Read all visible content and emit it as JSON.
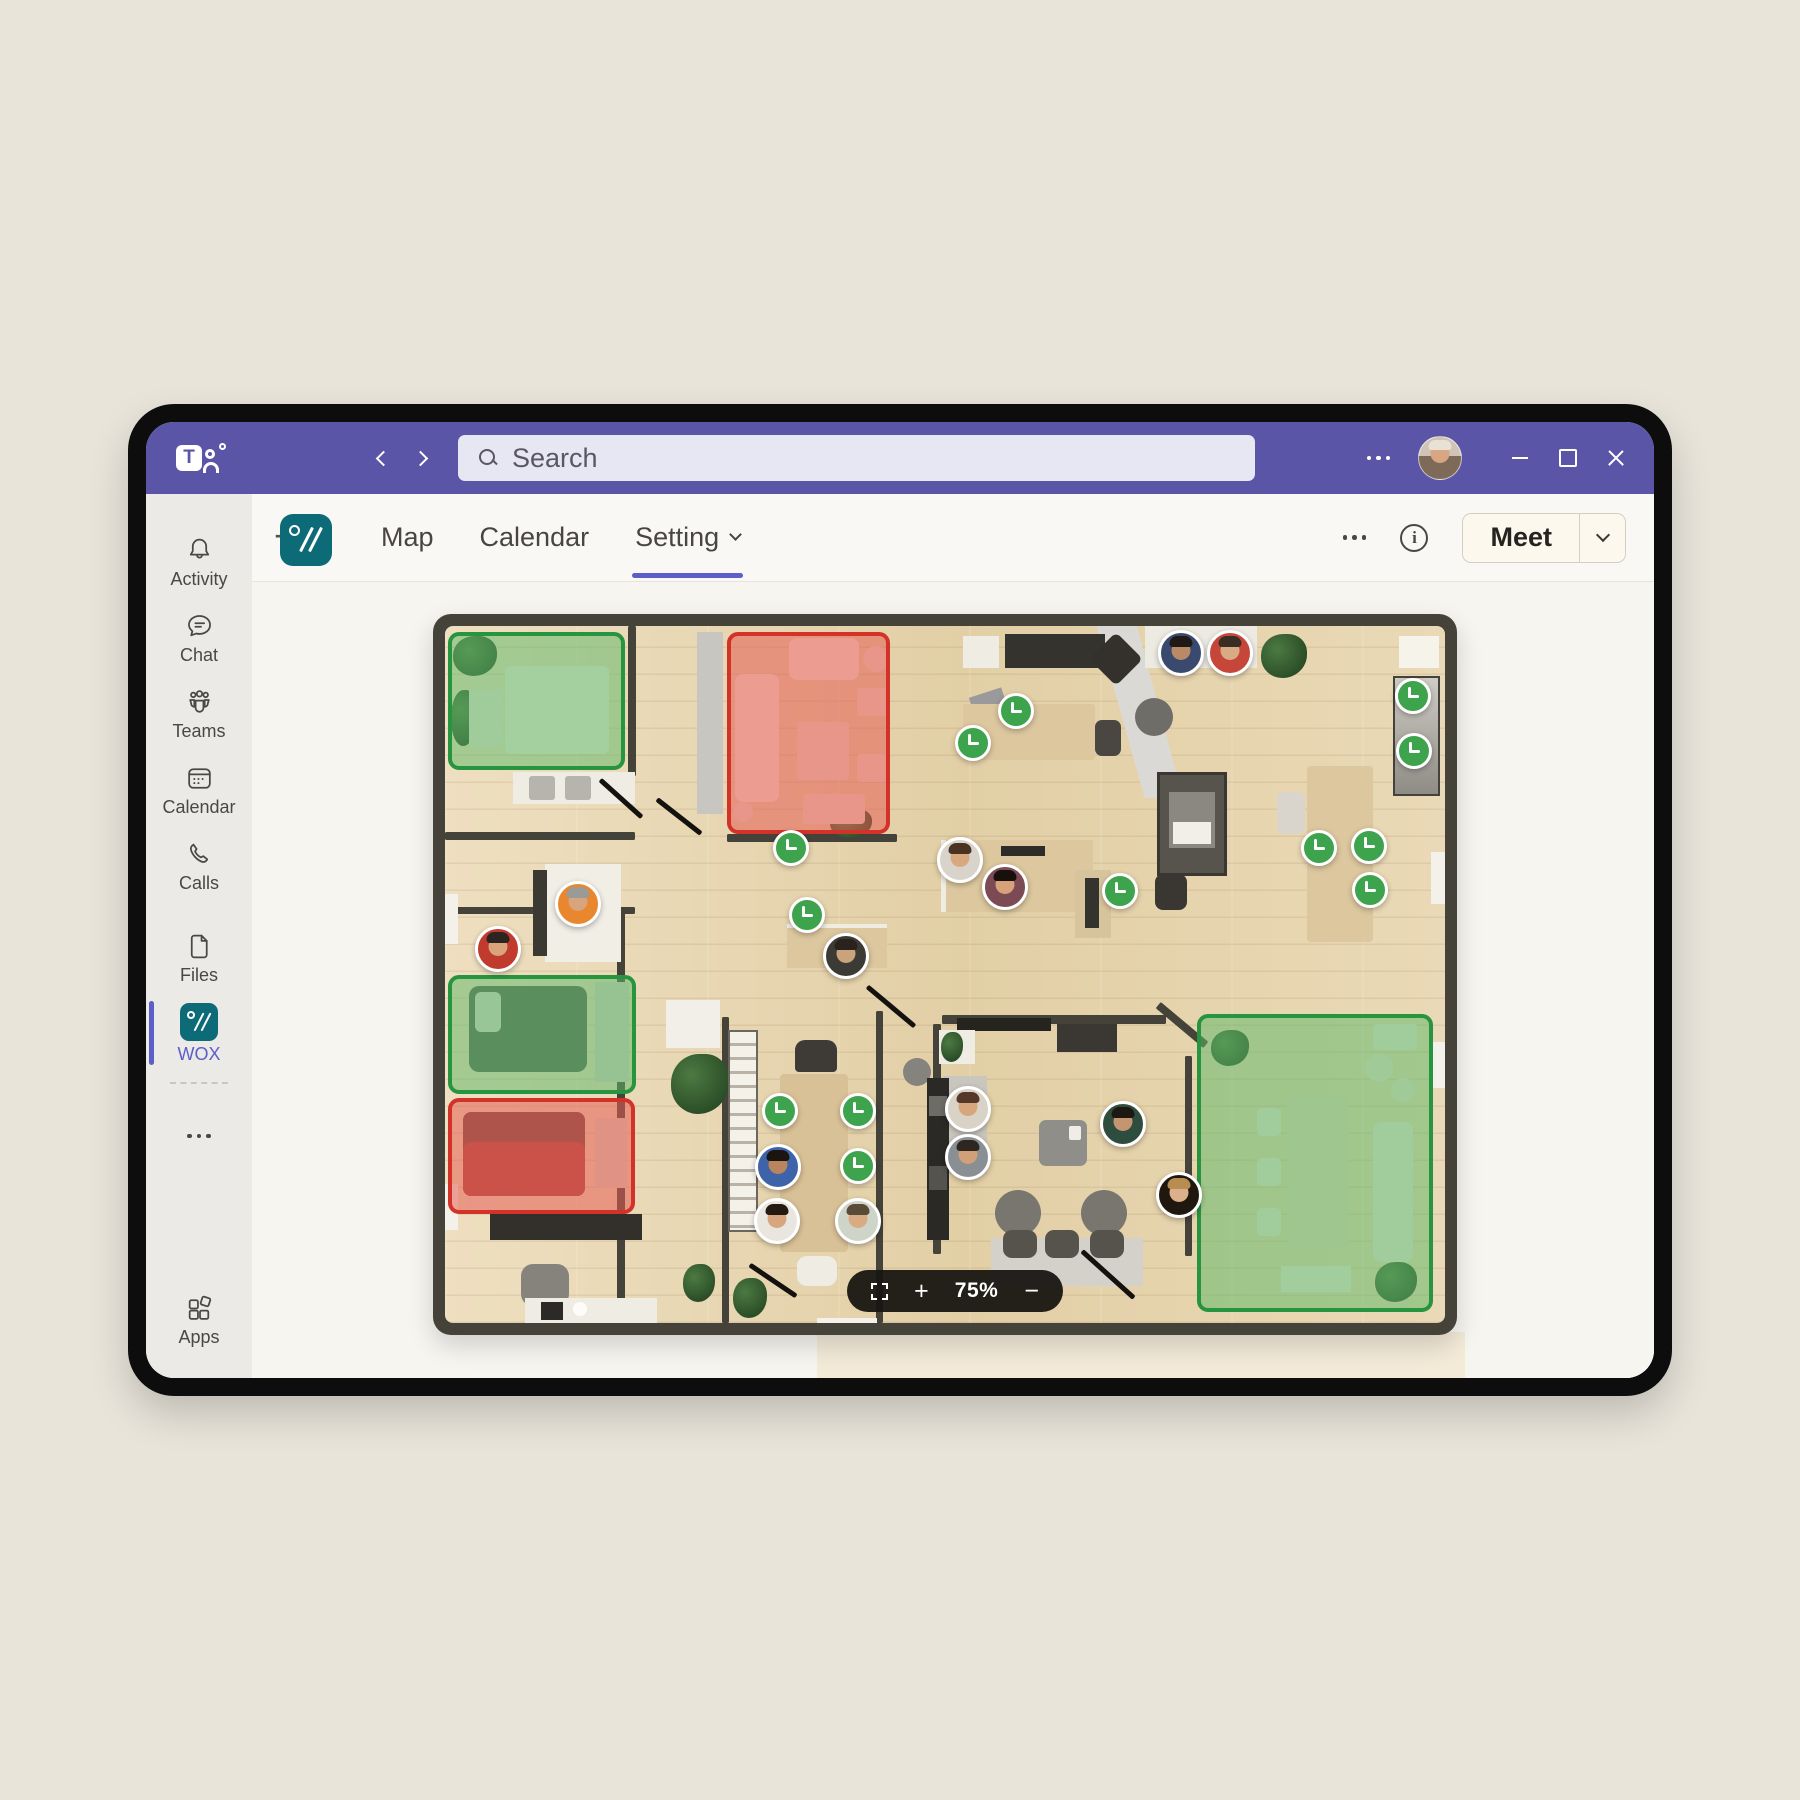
{
  "brand": {
    "teams_letter": "T"
  },
  "titlebar": {
    "search_placeholder": "Search"
  },
  "sidebar": {
    "items": [
      {
        "id": "activity",
        "label": "Activity"
      },
      {
        "id": "chat",
        "label": "Chat"
      },
      {
        "id": "teams",
        "label": "Teams"
      },
      {
        "id": "calendar",
        "label": "Calendar"
      },
      {
        "id": "calls",
        "label": "Calls"
      },
      {
        "id": "files",
        "label": "Files"
      },
      {
        "id": "wox",
        "label": "WOX"
      }
    ],
    "apps_label": "Apps"
  },
  "tabbar": {
    "tabs": [
      {
        "label": "Map",
        "cls": ""
      },
      {
        "label": "Calendar",
        "cls": ""
      },
      {
        "label": "Setting",
        "cls": "active has-caret"
      }
    ],
    "add_label": "+",
    "info_letter": "i",
    "meet_label": "Meet"
  },
  "map": {
    "zoom_level": "75%",
    "zoom_plus": "+",
    "zoom_minus": "−",
    "status_colors": {
      "available": "#27943f",
      "busy": "#d23228",
      "clock_badge": "#3ea34d"
    },
    "zones": [
      {
        "kind": "available",
        "cls": "available",
        "css": "left:3px;top:6px;width:177px;height:138px"
      },
      {
        "kind": "busy",
        "cls": "busy",
        "css": "left:282px;top:6px;width:163px;height:202px"
      },
      {
        "kind": "available",
        "cls": "available",
        "css": "left:3px;top:349px;width:188px;height:119px"
      },
      {
        "kind": "busy",
        "cls": "busy",
        "css": "left:3px;top:472px;width:187px;height:116px"
      },
      {
        "kind": "available",
        "cls": "available",
        "css": "left:752px;top:388px;width:236px;height:298px"
      }
    ],
    "clocks": [
      {
        "css": "left:328px;top:204px"
      },
      {
        "css": "left:344px;top:271px"
      },
      {
        "css": "left:553px;top:67px"
      },
      {
        "css": "left:510px;top:99px"
      },
      {
        "css": "left:950px;top:52px"
      },
      {
        "css": "left:951px;top:107px"
      },
      {
        "css": "left:856px;top:204px"
      },
      {
        "css": "left:906px;top:202px"
      },
      {
        "css": "left:907px;top:246px"
      },
      {
        "css": "left:657px;top:247px"
      },
      {
        "css": "left:317px;top:467px"
      },
      {
        "css": "left:395px;top:467px"
      },
      {
        "css": "left:395px;top:522px"
      }
    ],
    "people": [
      {
        "css": "left:110px;top:255px;--skin:#d7a47e;--hair:#9a9a96;--shirt:#e8872e"
      },
      {
        "css": "left:30px;top:300px;--skin:#d9a47c;--hair:#2c2420;--shirt:#c03a2e"
      },
      {
        "css": "left:378px;top:307px;--skin:#caa27c;--hair:#2a221c;--shirt:#3c3a34"
      },
      {
        "css": "left:713px;top:4px;--skin:#b98a66;--hair:#201a16;--shirt:#3a4a6e"
      },
      {
        "css": "left:762px;top:4px;--skin:#d9ab84;--hair:#3a2e24;--shirt:#c6473a"
      },
      {
        "css": "left:492px;top:211px;--skin:#d9a87f;--hair:#4a3322;--shirt:#d8d4cc"
      },
      {
        "css": "left:537px;top:238px;--skin:#d7a27a;--hair:#17100c;--shirt:#7b4a55"
      },
      {
        "css": "left:310px;top:518px;--skin:#b9845e;--hair:#1c140e;--shirt:#3e63a8"
      },
      {
        "css": "left:309px;top:572px;--skin:#d8a67e;--hair:#241a12;--shirt:#e9e6df"
      },
      {
        "css": "left:390px;top:572px;--skin:#d9ab82;--hair:#5a4a38;--shirt:#cfd4c8"
      },
      {
        "css": "left:500px;top:460px;--skin:#d8a67c;--hair:#55382a;--shirt:#d9d2c6"
      },
      {
        "css": "left:500px;top:508px;--skin:#d2a078;--hair:#2e2620;--shirt:#8a8f94"
      },
      {
        "css": "left:655px;top:475px;--skin:#c59470;--hair:#1e1813;--shirt:#2f4d3e"
      },
      {
        "css": "left:711px;top:546px;--skin:#dcb08a;--hair:#b98c52;--shirt:#20180f"
      }
    ],
    "furniture": [
      {
        "cls": "f-wall",
        "css": "left:183px;top:0;width:8px;height:150px"
      },
      {
        "cls": "f-wall",
        "css": "left:0;top:206px;width:190px;height:8px"
      },
      {
        "cls": "f-wall",
        "css": "left:282px;top:208px;width:170px;height:8px"
      },
      {
        "cls": "f-wall",
        "css": "left:0;top:281px;width:190px;height:7px"
      },
      {
        "cls": "f-wall",
        "css": "left:172px;top:281px;width:8px;height:416px"
      },
      {
        "cls": "f-wall",
        "css": "left:277px;top:391px;width:7px;height:306px"
      },
      {
        "cls": "f-wall",
        "css": "left:431px;top:385px;width:7px;height:312px"
      },
      {
        "cls": "f-wall",
        "css": "left:497px;top:389px;width:224px;height:9px"
      },
      {
        "cls": "f-wall",
        "css": "left:488px;top:398px;width:8px;height:230px"
      },
      {
        "cls": "f-wall",
        "css": "left:706px;top:395px;width:62px;height:8px;transform:rotate(40deg)"
      },
      {
        "cls": "f-wall",
        "css": "left:740px;top:430px;width:7px;height:200px"
      },
      {
        "cls": "f",
        "css": "left:252px;top:6px;width:26px;height:182px;background:#c8c6c1"
      },
      {
        "cls": "f",
        "css": "left:642px;top:0;width:96px;height:172px;background:#dbd9d5;clip-path:polygon(10% 0,52% 0,100% 100%,60% 100%)"
      },
      {
        "cls": "f",
        "css": "left:372px;top:692px;width:60px;height:7px;background:#f4f1ea"
      },
      {
        "cls": "f",
        "css": "left:68px;top:146px;width:122px;height:32px;background:#efece3"
      },
      {
        "cls": "f",
        "css": "left:84px;top:150px;width:26px;height:24px;background:#b7b4ae;border-radius:3px"
      },
      {
        "cls": "f",
        "css": "left:120px;top:150px;width:26px;height:24px;background:#b7b4ae;border-radius:3px"
      },
      {
        "cls": "f",
        "css": "left:100px;top:238px;width:76px;height:98px;background:#f1eee6"
      },
      {
        "cls": "f",
        "css": "left:88px;top:244px;width:14px;height:86px;background:#3c3933"
      },
      {
        "cls": "f",
        "css": "left:342px;top:298px;width:100px;height:44px;background:#dcc79e;border-top:4px solid #efece4"
      },
      {
        "cls": "f",
        "css": "left:560px;top:8px;width:100px;height:34px;background:#35332e"
      },
      {
        "cls": "f",
        "css": "left:518px;top:10px;width:36px;height:32px;background:#efece4"
      },
      {
        "cls": "f",
        "css": "left:527px;top:66px;width:34px;height:26px;background:#9b999b;transform:rotate(-18deg)"
      },
      {
        "cls": "f",
        "css": "left:652px;top:14px;width:38px;height:38px;background:#34312c;transform:rotate(45deg);border-radius:6px"
      },
      {
        "cls": "f",
        "css": "left:518px;top:78px;width:132px;height:56px;background:#dcc79e;border-radius:3px"
      },
      {
        "cls": "f",
        "css": "left:650px;top:94px;width:26px;height:36px;background:#4a4742;border-radius:7px"
      },
      {
        "cls": "f",
        "css": "left:690px;top:72px;width:38px;height:38px;background:#6f6d68;border-radius:50%"
      },
      {
        "cls": "f",
        "css": "left:700px;top:0;width:112px;height:42px;background:#edeae2"
      },
      {
        "cls": "f-plant",
        "css": "left:816px;top:8px;width:46px;height:44px"
      },
      {
        "cls": "f",
        "css": "left:954px;top:10px;width:40px;height:32px;background:#f6f3ea"
      },
      {
        "cls": "f",
        "css": "left:948px;top:50px;width:47px;height:120px;background:linear-gradient(#cfccc6,#8f8c86);border:2px solid #45423a"
      },
      {
        "cls": "f",
        "css": "left:712px;top:146px;width:70px;height:104px;background:#57544e;border:3px solid #3a3732"
      },
      {
        "cls": "f",
        "css": "left:724px;top:166px;width:46px;height:56px;background:#8b8881"
      },
      {
        "cls": "f",
        "css": "left:728px;top:196px;width:38px;height:22px;background:#f1efe8"
      },
      {
        "cls": "f",
        "css": "left:862px;top:140px;width:66px;height:176px;background:#dcc79e;border-radius:4px"
      },
      {
        "cls": "f",
        "css": "left:832px;top:166px;width:28px;height:42px;background:#d9d5cc;border-radius:7px"
      },
      {
        "cls": "f",
        "css": "left:986px;top:226px;width:14px;height:52px;background:#f4f1ea"
      },
      {
        "cls": "f",
        "css": "left:986px;top:416px;width:14px;height:46px;background:#f4f1ea"
      },
      {
        "cls": "f",
        "css": "left:496px;top:214px;width:152px;height:72px;background:#dcc79e;border-left:5px solid #efece4"
      },
      {
        "cls": "f",
        "css": "left:556px;top:220px;width:44px;height:10px;background:#2e2c28"
      },
      {
        "cls": "f",
        "css": "left:630px;top:244px;width:36px;height:68px;background:#d8c49c"
      },
      {
        "cls": "f",
        "css": "left:640px;top:252px;width:14px;height:50px;background:#35332e"
      },
      {
        "cls": "f",
        "css": "left:710px;top:248px;width:32px;height:36px;background:#3a3733;border-radius:8px"
      },
      {
        "cls": "f",
        "css": "left:512px;top:392px;width:94px;height:13px;background:#26241f"
      },
      {
        "cls": "f",
        "css": "left:612px;top:398px;width:60px;height:28px;background:#3b3833"
      },
      {
        "cls": "f",
        "css": "left:494px;top:404px;width:36px;height:34px;background:#efece4"
      },
      {
        "cls": "f-plant",
        "css": "left:496px;top:406px;width:22px;height:30px"
      },
      {
        "cls": "f",
        "css": "left:458px;top:432px;width:28px;height:28px;background:#85837d;border-radius:50%"
      },
      {
        "cls": "f",
        "css": "left:498px;top:450px;width:44px;height:98px;background:#c9c6be"
      },
      {
        "cls": "f",
        "css": "left:594px;top:494px;width:48px;height:46px;background:#908e89;border-radius:7px"
      },
      {
        "cls": "f",
        "css": "left:624px;top:500px;width:12px;height:14px;background:#f0ede6;border-radius:2px"
      },
      {
        "cls": "f",
        "css": "left:550px;top:564px;width:46px;height:46px;background:#78766f;border-radius:50%"
      },
      {
        "cls": "f",
        "css": "left:636px;top:564px;width:46px;height:46px;background:#78766f;border-radius:50%"
      },
      {
        "cls": "f",
        "css": "left:546px;top:612px;width:152px;height:48px;background:#d4d1ca"
      },
      {
        "cls": "f",
        "css": "left:558px;top:604px;width:34px;height:28px;background:#56534d;border-radius:9px"
      },
      {
        "cls": "f",
        "css": "left:600px;top:604px;width:34px;height:28px;background:#56534d;border-radius:9px"
      },
      {
        "cls": "f",
        "css": "left:645px;top:604px;width:34px;height:28px;background:#56534d;border-radius:9px"
      },
      {
        "cls": "f",
        "css": "left:482px;top:452px;width:22px;height:162px;background:#2b2926"
      },
      {
        "cls": "f",
        "css": "left:484px;top:470px;width:18px;height:20px;background:#6e6c66"
      },
      {
        "cls": "f",
        "css": "left:484px;top:540px;width:18px;height:24px;background:#55534d"
      },
      {
        "cls": "f-plant",
        "css": "left:226px;top:428px;width:58px;height:60px"
      },
      {
        "cls": "f-plant",
        "css": "left:238px;top:638px;width:32px;height:38px"
      },
      {
        "cls": "f-plant",
        "css": "left:288px;top:652px;width:34px;height:40px"
      },
      {
        "cls": "f",
        "css": "left:221px;top:374px;width:54px;height:48px;background:#f2efe8"
      },
      {
        "cls": "f-stairs",
        "css": "left:283px;top:404px;width:30px;height:202px"
      },
      {
        "cls": "f",
        "css": "left:335px;top:448px;width:68px;height:178px;background:#d9c197;border-radius:4px"
      },
      {
        "cls": "f",
        "css": "left:350px;top:414px;width:42px;height:32px;background:#3e3b36;border-radius:10px 10px 4px 4px"
      },
      {
        "cls": "f",
        "css": "left:352px;top:630px;width:40px;height:30px;background:#efece4;border-radius:10px"
      },
      {
        "cls": "f",
        "css": "left:45px;top:588px;width:152px;height:26px;background:#332f2a"
      },
      {
        "cls": "f",
        "css": "left:76px;top:638px;width:48px;height:42px;background:#85837b;border-radius:12px"
      },
      {
        "cls": "f",
        "css": "left:80px;top:672px;width:132px;height:26px;background:#efece3"
      },
      {
        "cls": "f",
        "css": "left:96px;top:676px;width:22px;height:18px;background:#2c2a26"
      },
      {
        "cls": "f",
        "css": "left:128px;top:676px;width:14px;height:14px;background:#fdfcf8;border-radius:50%"
      },
      {
        "cls": "f",
        "css": "left:0;top:268px;width:13px;height:50px;background:#f4f1ea"
      },
      {
        "cls": "f",
        "css": "left:0;top:558px;width:13px;height:46px;background:#f4f1ea"
      },
      {
        "cls": "f-door",
        "css": "left:148px;top:170px;width:56px;height:5px;transform:rotate(42deg)"
      },
      {
        "cls": "f-door",
        "css": "left:206px;top:188px;width:56px;height:5px;transform:rotate(38deg)"
      },
      {
        "cls": "f-door",
        "css": "left:415px;top:378px;width:62px;height:5px;transform:rotate(40deg)"
      },
      {
        "cls": "f-door",
        "css": "left:300px;top:652px;width:56px;height:5px;transform:rotate(34deg)"
      },
      {
        "cls": "f-door",
        "css": "left:628px;top:646px;width:70px;height:5px;transform:rotate(42deg)"
      },
      {
        "cls": "f-plant",
        "css": "left:385px;top:182px;width:42px;height:30px"
      },
      {
        "cls": "f",
        "css": "left:290px;top:48px;width:44px;height:128px;background:#f4e8dc;border-radius:8px"
      },
      {
        "cls": "f",
        "css": "left:344px;top:12px;width:70px;height:42px;background:#f4e8dc;border-radius:8px"
      },
      {
        "cls": "f",
        "css": "left:352px;top:96px;width:52px;height:58px;background:#ecdccc;border-radius:4px"
      },
      {
        "cls": "f",
        "css": "left:412px;top:62px;width:30px;height:28px;background:#ecdccc;border-radius:4px"
      },
      {
        "cls": "f",
        "css": "left:412px;top:128px;width:30px;height:28px;background:#ecdccc;border-radius:4px"
      },
      {
        "cls": "f",
        "css": "left:358px;top:168px;width:62px;height:30px;background:#ecdccc;border-radius:4px"
      },
      {
        "cls": "f",
        "css": "left:418px;top:20px;width:26px;height:26px;background:#eadacc;border-radius:50%"
      },
      {
        "cls": "f",
        "css": "left:288px;top:176px;width:20px;height:20px;background:#eadacc;border-radius:50%"
      },
      {
        "cls": "f-plant",
        "css": "left:8px;top:10px;width:44px;height:40px"
      },
      {
        "cls": "f-plant",
        "css": "left:6px;top:64px;width:26px;height:56px"
      },
      {
        "cls": "f",
        "css": "left:60px;top:40px;width:104px;height:88px;background:#efe9da;border-radius:6px"
      },
      {
        "cls": "f",
        "css": "left:24px;top:64px;width:34px;height:56px;background:#e7e0cf"
      },
      {
        "cls": "f",
        "css": "left:24px;top:360px;width:118px;height:86px;background:#55604e;border-radius:10px"
      },
      {
        "cls": "f",
        "css": "left:30px;top:366px;width:26px;height:40px;background:#d8d5c8;border-radius:6px"
      },
      {
        "cls": "f",
        "css": "left:150px;top:356px;width:34px;height:100px;background:#d4cdbc"
      },
      {
        "cls": "f",
        "css": "left:18px;top:486px;width:122px;height:84px;background:#6e4a42;border-radius:8px"
      },
      {
        "cls": "f",
        "css": "left:18px;top:516px;width:122px;height:54px;background:#a8453a;border-radius:8px"
      },
      {
        "cls": "f",
        "css": "left:150px;top:492px;width:32px;height:70px;background:#d9d2c2"
      },
      {
        "cls": "f",
        "css": "left:842px;top:470px;width:62px;height:152px;background:#e3d5b8;border-radius:4px"
      },
      {
        "cls": "f",
        "css": "left:812px;top:482px;width:24px;height:28px;background:#e8e2d2;border-radius:5px"
      },
      {
        "cls": "f",
        "css": "left:812px;top:532px;width:24px;height:28px;background:#e8e2d2;border-radius:5px"
      },
      {
        "cls": "f",
        "css": "left:812px;top:582px;width:24px;height:28px;background:#e8e2d2;border-radius:5px"
      },
      {
        "cls": "f",
        "css": "left:928px;top:496px;width:40px;height:140px;background:#e9e4d6;border-radius:8px"
      },
      {
        "cls": "f",
        "css": "left:920px;top:428px;width:28px;height:28px;background:#e5dfce;border-radius:50%"
      },
      {
        "cls": "f",
        "css": "left:946px;top:452px;width:24px;height:24px;background:#e5dfce;border-radius:50%"
      },
      {
        "cls": "f-plant",
        "css": "left:766px;top:404px;width:38px;height:36px"
      },
      {
        "cls": "f-plant",
        "css": "left:930px;top:636px;width:42px;height:40px"
      },
      {
        "cls": "f",
        "css": "left:928px;top:398px;width:44px;height:26px;background:#e9e4d6;border-radius:4px"
      },
      {
        "cls": "f",
        "css": "left:836px;top:640px;width:70px;height:26px;background:#eae5d6"
      }
    ]
  }
}
